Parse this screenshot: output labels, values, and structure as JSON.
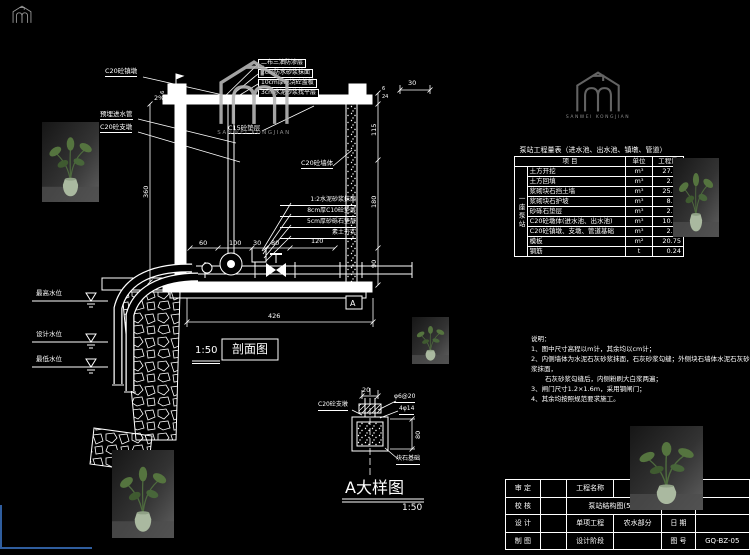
{
  "watermark": {
    "text": "SANWEI KONGJIAN"
  },
  "section_view": {
    "title": "剖面图",
    "scale": "1:50",
    "top_stack": [
      "二布三油防渗层",
      "2cm防水砂浆抹面",
      "10cm厚现浇砼盖板",
      "3cm水泥砂浆找平层"
    ],
    "left_labels": {
      "anchor": "C20砼镇墩",
      "pipe": "预埋进水管",
      "pier": "C20砼支墩"
    },
    "inner_labels": {
      "cushion": "C15砼垫层",
      "wall": "C20砼墙体"
    },
    "right_stack": [
      "1:2水泥砂浆抹面",
      "8cm厚C10砼垫层",
      "5cm厚砂砾石垫层",
      "素土夯实"
    ],
    "slope_left": "2%",
    "slope_right": "2%",
    "water_levels": {
      "high": "最高水位",
      "design": "设计水位",
      "low": "最低水位"
    },
    "dims": {
      "top_left": "6",
      "top_right": "30",
      "left_height": "360",
      "inner_chain": [
        "60",
        "100",
        "30",
        "80",
        "120"
      ],
      "bottom_total": "426",
      "right_chain": [
        "115",
        "180",
        "90"
      ],
      "micro": [
        "6",
        "24"
      ]
    },
    "marker": "A"
  },
  "detail_view": {
    "title": "A大样图",
    "scale": "1:50",
    "labels": {
      "pier": "C20砼支墩",
      "stirrup": "φ6@20",
      "rebar": "4φ14",
      "foundation": "块石基础"
    },
    "dims": {
      "top": "20",
      "right": "80"
    }
  },
  "quantity_table": {
    "title": "泵站工程量表（进水池、出水池、镇墩、管道）",
    "group_label": "一座泵站",
    "headers": [
      "项  目",
      "单位",
      "工程量"
    ],
    "rows": [
      [
        "土方开挖",
        "m³",
        "27.60"
      ],
      [
        "土方回填",
        "m³",
        "2.06"
      ],
      [
        "浆砌块石挡土墙",
        "m³",
        "25.60"
      ],
      [
        "浆砌块石护坡",
        "m³",
        "8.09"
      ],
      [
        "砂砾石垫层",
        "m³",
        "2.06"
      ],
      [
        "C20砼墩体(进水池、出水池)",
        "m³",
        "10.60"
      ],
      [
        "C20砼镇墩、支墩、管道基础",
        "m³",
        "2.06"
      ],
      [
        "模板",
        "m²",
        "20.75"
      ],
      [
        "钢筋",
        "t",
        "0.24"
      ]
    ]
  },
  "notes": {
    "heading": "说明：",
    "lines": [
      "1、图中尺寸高程以m计，其余均以cm计；",
      "2、内侧墙体为水泥石灰砂浆抹面，石灰砂浆勾缝；外侧块石墙体水泥石灰砂浆抹面，",
      "石灰砂浆勾缝后，内侧粉刷大白浆两遍；",
      "3、闸门尺寸1.2×1.6m，采用钢闸门；",
      "4、其余均按照规范要求施工。"
    ]
  },
  "title_block": {
    "row_labels": [
      "审  定",
      "校  核",
      "设  计",
      "制  图"
    ],
    "project_name_label": "工程名称",
    "drawing_title": "泵站结构图(5/5)",
    "sub_project_label": "单项工程",
    "sub_project_value": "农水部分",
    "stage_label": "设计阶段",
    "scale_label": "比  例",
    "date_label": "日  期",
    "number_label": "图  号",
    "number_value": "GQ-BZ-05"
  }
}
